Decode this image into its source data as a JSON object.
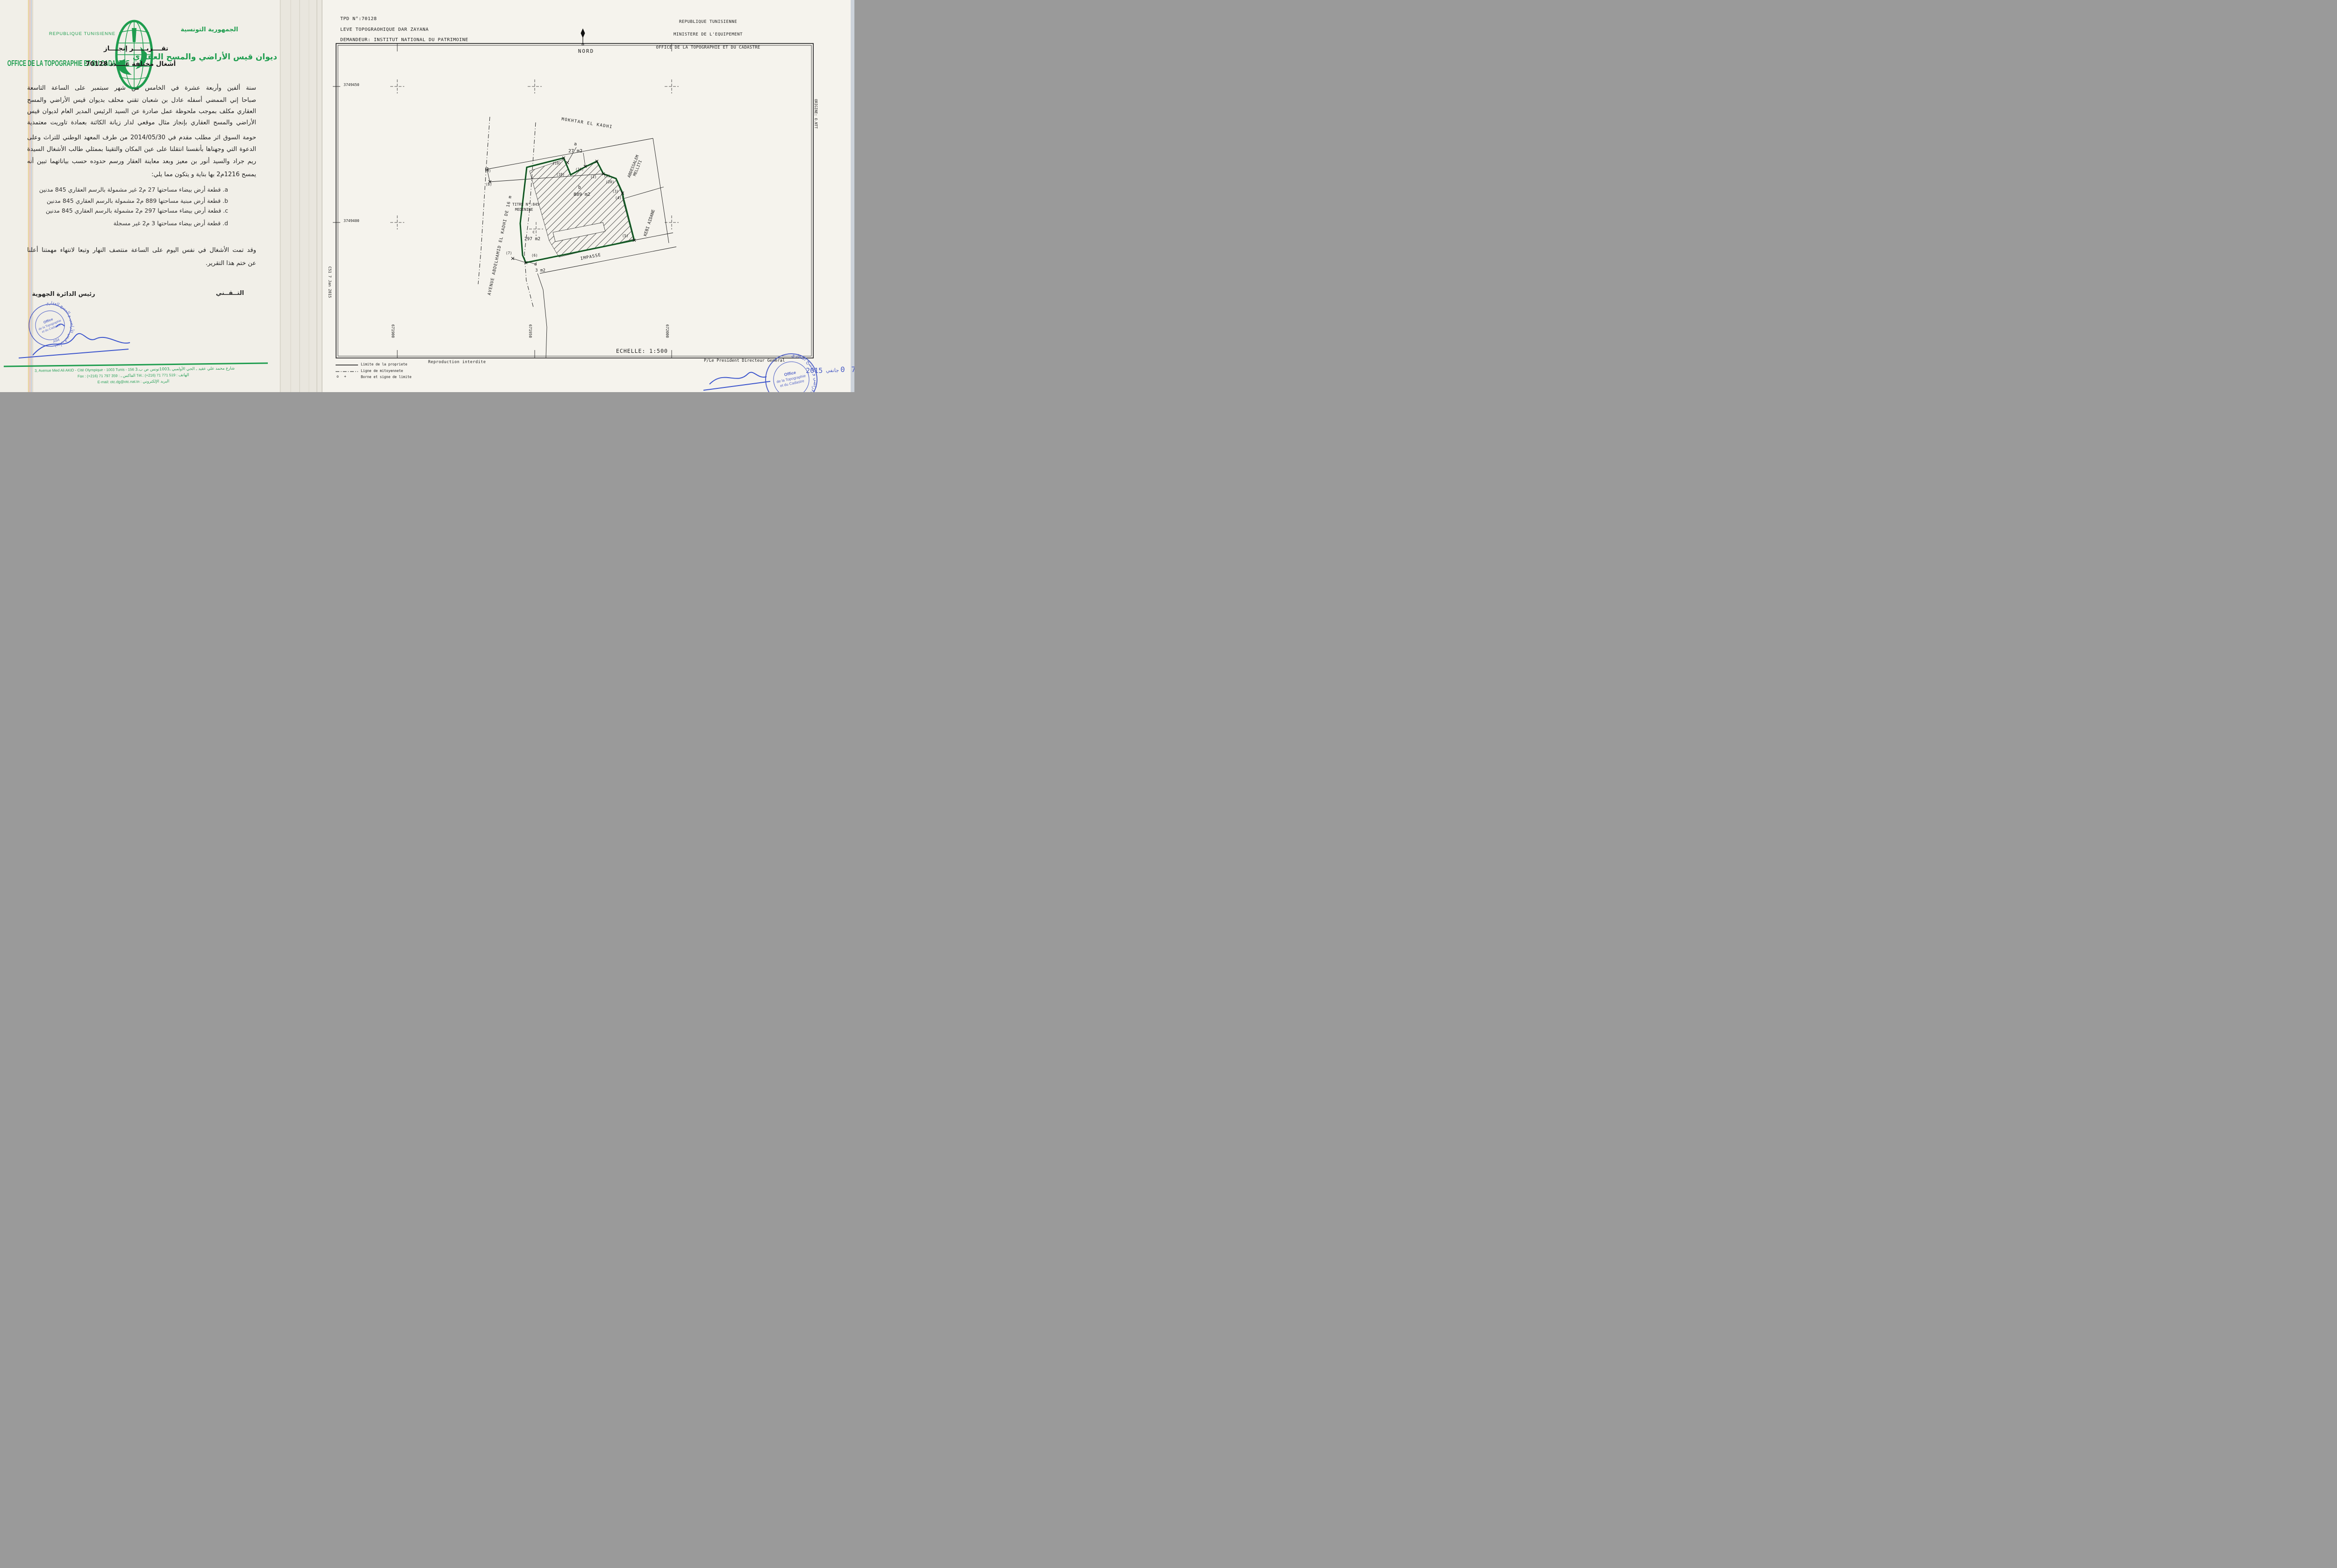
{
  "left": {
    "letterhead": {
      "fr1": "REPUBLIQUE TUNISIENNE",
      "fr2": "OFFICE DE LA TOPOGRAPHIE ET DU CADASTRE",
      "ar1": "الجمهورية التونسية",
      "ar2": "ديوان قيس الأراضي والمسح العقاري"
    },
    "title1": "تقــــريــــــر إنجــــاز",
    "title2": "أشغال مختلفة عــــدد 70128",
    "body": [
      "سنة ألفين وأربعة عشرة في الخامس من شهر سبتمبر على الساعة التاسعة",
      "صباحا إني الممضي أسفله عادل بن شعبان تقني محلف بديوان قيس الأراضي والمسح",
      "العقاري مكلف بموجب ملحوظة عمل صادرة عن السيد الرئيس المدير العام لديوان قيس",
      "الأراضي والمسح العقاري بإنجاز مثال موقعي لدار زيانة الكائنة بعمادة تاوريت معتمدية",
      "حومة السوق اثر مطلب مقدم في 2014/05/30 من طرف المعهد الوطني للتراث وعلى",
      "الدعوة التي وجهناها بأنفسنا انتقلنا على عين المكان والتقينا بممثلي طالب الأشغال السيدة",
      "ريم جراد والسيد أنور بن معيز وبعد معاينة العقار ورسم حدوده حسب بياناتهما تبين أنه",
      "يمسح 1216م2 بها بناية و يتكون مما يلي:"
    ],
    "items": [
      "a. قطعة أرض بيضاء مساحتها 27 م2 غير مشمولة بالرسم العقاري 845 مدنين",
      "b. قطعة أرض مبنية مساحتها 889 م2 مشمولة بالرسم العقاري 845 مدنين",
      "c. قطعة أرض بيضاء مساحتها 297 م2 مشمولة بالرسم العقاري 845 مدنين",
      "d. قطعة أرض بيضاء مساحتها 3 م2 غير مسجلة"
    ],
    "closing": [
      "وقد تمت الأشغال في نفس اليوم على الساعة منتصف النهار وتبعا لانتهاء مهمتنا أعلنا",
      "عن ختم هذا التقرير."
    ],
    "sig_right_role": "التــقــني",
    "sig_left_role": "رئيس الدائرة الجهوية",
    "stamp": {
      "ring": "ديوان قيس الأراضي و المسح العقاري",
      "l1": "Office",
      "l2": "de la Topographie",
      "l3": "et du Cadastre",
      "code": "A94"
    },
    "footer": {
      "f1_fr": "3, Avenue Med Ali AKID - Cité Olympique - 1003 Tunis  - 156",
      "f1_ar": "3.شارع محمد علي عقيد ـ الحي الأولمبي ـ1003تونس ص ب",
      "f2_fr1": "Fax : (+216) 71 797 359 :",
      "f2_ar1": "الفاكس",
      "f2_sep": "ـ",
      "f2_fr2": "Tél.: (+216) 71 771 519 :",
      "f2_ar2": "الهاتف",
      "f3_fr": "E-mail: otc.dg@otc.nat.tn :",
      "f3_ar": "البريد الإلكتروني"
    }
  },
  "plan": {
    "tpd": "TPD N°:70128",
    "leve": "LEVE TOPOGRAOHIQUE   DAR ZAYANA",
    "demandeur": "DEMANDEUR: INSTITUT NATIONAL DU PATRIMOINE",
    "org": [
      "REPUBLIQUE TUNISIENNE",
      "MINISTERE DE L'EQUIPEMENT",
      "OFFICE DE LA TOPOGRAPHIE ET DU CADASTRE"
    ],
    "nord": "NORD",
    "origine": "ORIGINE: O.NTT",
    "filecode": "C51   7 Jan 2015",
    "grid": {
      "northings": [
        "3749450",
        "3749400"
      ],
      "eastings": [
        "671900",
        "671950",
        "672000"
      ]
    },
    "titre": "TITRE N°:845",
    "commune": "MEDENINE",
    "parcels": {
      "a": {
        "label": "a",
        "area": "27 m2"
      },
      "b": {
        "label": "b",
        "area": "889 m2"
      },
      "c": {
        "label": "c",
        "area": "297 m2"
      },
      "d": {
        "label": "d",
        "area": "3 m2"
      }
    },
    "streets": {
      "mokhtar": "MOKHTAR  EL  KADHI",
      "abdessalem1": "ABDESSALEM",
      "abdessalem2": "MELLITI",
      "kebi": "KEBI  AIDANE",
      "impasse": "IMPASSE",
      "avenue": "AVENUE  ABDELHAMID  EL  KADHI  DE  16  m"
    },
    "vertices": [
      "(1)",
      "(2)",
      "(3)",
      "(4)",
      "(5)",
      "(6)",
      "(7)",
      "(8)",
      "(9)",
      "(16)",
      "(18)",
      "(19)",
      "(20)"
    ],
    "legend": {
      "l1": "Limite  de  la  propriete",
      "l2": "Ligne  de  mitoyennete",
      "l3": "Borne  et  signe  de  limite",
      "borne_o": "o",
      "borne_plus": "+"
    },
    "reproduction": "Reproduction  interdite",
    "echelle": "ECHELLE:   1:500",
    "president": "P/Le  President  Directeur  General",
    "stamp": {
      "ring": "ديوان قيس الاراضي و المسح العقاري",
      "l1": "Office",
      "l2": "de la Topographie",
      "l3": "et du Cadastre",
      "code": "A94"
    },
    "date": {
      "year": "2015",
      "month": "جانفي",
      "day": "0 7"
    }
  },
  "colors": {
    "letterhead_green": "#1f9d4f",
    "boundary_green": "#1b7a33",
    "stamp_blue": "#4a5cc5",
    "paper": "#f1efe8"
  }
}
